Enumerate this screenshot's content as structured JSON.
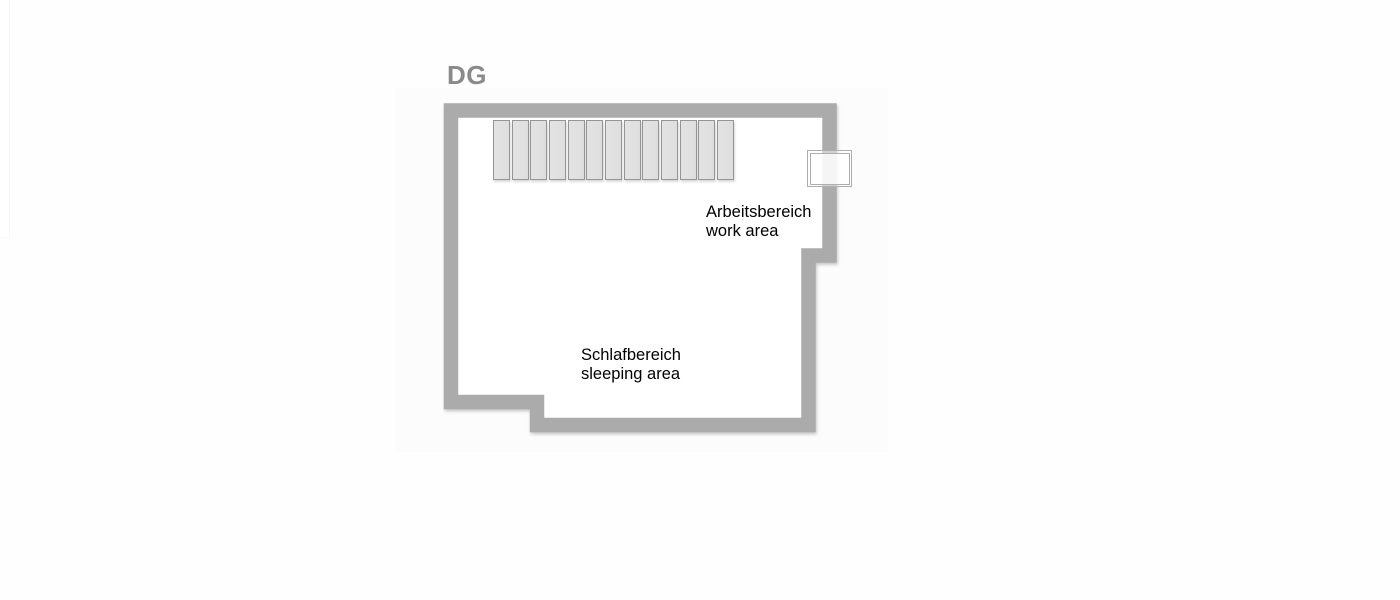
{
  "page": {
    "background_color": "#fefefe"
  },
  "floor_plan": {
    "floor_label": "DG",
    "floor_label_color": "#8a8a8a",
    "card_background": "#fcfcfc",
    "wall_color": "#ababab",
    "room_fill": "#ffffff",
    "text_color": "#000000",
    "areas": {
      "work": {
        "name_de": "Arbeitsbereich",
        "name_en": "work area"
      },
      "sleeping": {
        "name_de": "Schlafbereich",
        "name_en": "sleeping area"
      }
    },
    "staircase": {
      "step_count": 13,
      "tread_fill": "#e3e3e3",
      "tread_border": "#959595"
    },
    "window": {
      "frame_color": "#aeaeae"
    }
  }
}
